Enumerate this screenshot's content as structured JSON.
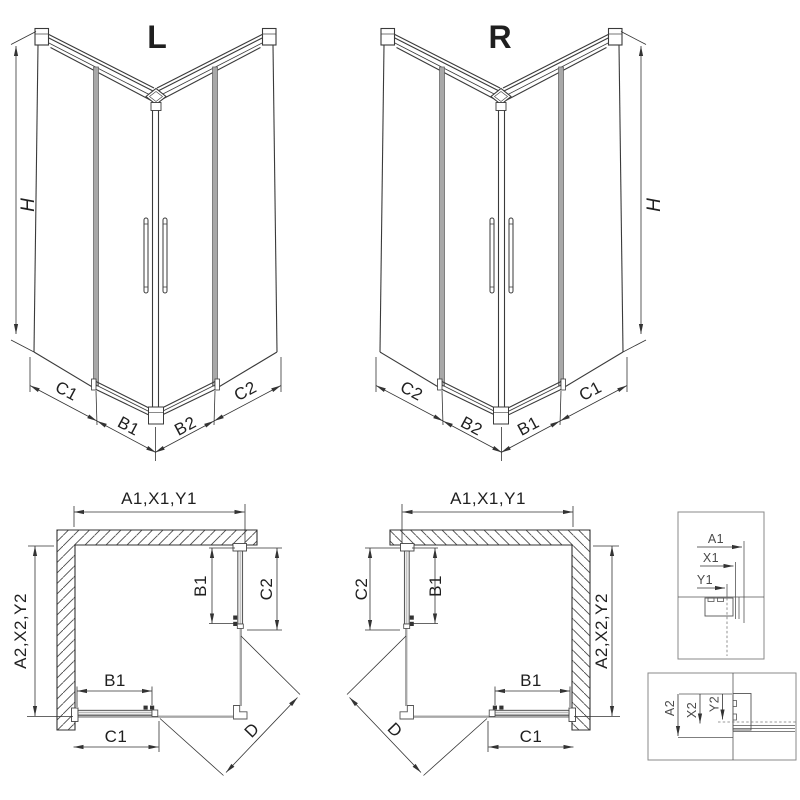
{
  "diagram": {
    "iso_left": {
      "label": "L",
      "height": "H",
      "dim_c1": "C1",
      "dim_b1": "B1",
      "dim_b2": "B2",
      "dim_c2": "C2"
    },
    "iso_right": {
      "label": "R",
      "height": "H",
      "dim_c2": "C2",
      "dim_b2": "B2",
      "dim_b1": "B1",
      "dim_c1": "C1"
    },
    "plan_left": {
      "width_dim": "A1,X1,Y1",
      "depth_dim": "A2,X2,Y2",
      "door_side": "B1",
      "fixed_side": "C2",
      "door_bottom": "B1",
      "fixed_bottom": "C1",
      "diagonal": "D"
    },
    "plan_right": {
      "width_dim": "A1,X1,Y1",
      "depth_dim": "A2,X2,Y2",
      "door_side": "B1",
      "fixed_side": "C2",
      "door_bottom": "B1",
      "fixed_bottom": "C1",
      "diagonal": "D"
    },
    "detail_top": {
      "d1": "A1",
      "d2": "X1",
      "d3": "Y1"
    },
    "detail_bottom": {
      "d1": "A2",
      "d2": "X2",
      "d3": "Y2"
    },
    "colors": {
      "line": "#3a3a3a",
      "secondary": "#a8a8a8",
      "dim": "#333333",
      "box_border": "#8a8a8a",
      "background": "#ffffff"
    }
  }
}
